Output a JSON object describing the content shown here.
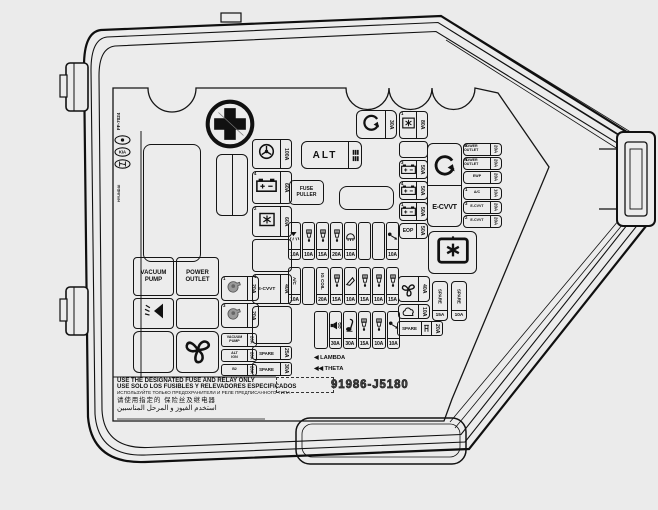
{
  "cover": {
    "part_number": "91986-J5180",
    "side_code": "FF-7024",
    "side_brand": "HYUNDAI"
  },
  "warnings": [
    "USE THE DESIGNATED FUSE AND RELAY ONLY",
    "USE SOLO LOS FUSIBLES Y RELEVADORES ESPECIFICADOS",
    "ИСПОЛЬЗУЙТЕ ТОЛЬКО ПРЕДОХРАНИТЕЛИ И РЕЛЕ ПРЕДПИСАННОГО ТИПА",
    "请使用指定的 保险丝及继电器",
    "استخدم الفيوز و المرحل المناسبين"
  ],
  "legend": {
    "lambda_prefix": "◀",
    "lambda": "LAMBDA",
    "theta_prefix": "◀◀",
    "theta": "THETA"
  },
  "named_boxes": {
    "alt": "ALT",
    "fuse_puller": "FUSE PULLER",
    "ecvvt_big": "E-CVVT",
    "vacuum_pump": "VACUUM PUMP",
    "power_outlet": "POWER OUTLET"
  },
  "col_a": [
    {
      "num": "",
      "icon": "eps-icon",
      "amp": "100A"
    },
    {
      "num": "4",
      "icon": "battery-icon",
      "amp": "60A"
    },
    {
      "num": "2",
      "icon": "star-box-icon",
      "amp": "60A"
    },
    {
      "blank": true
    },
    {
      "num": "1",
      "label": "E-CVVT",
      "amp": "40A"
    },
    {
      "blank": true
    },
    {
      "label": "SPARE",
      "amp": "25A"
    },
    {
      "label": "SPARE",
      "amp": "30A"
    }
  ],
  "top_fuse": {
    "icon": "rotate-arrow-icon",
    "amp": "30A"
  },
  "col_b": [
    {
      "num": "1",
      "icon": "star-box-icon",
      "amp": "80A"
    },
    {
      "num": "3",
      "icon": "battery-icon",
      "amp": "50A"
    },
    {
      "num": "4",
      "icon": "battery-icon",
      "amp": "50A"
    },
    {
      "num": "1",
      "icon": "battery-icon",
      "amp": "50A"
    },
    {
      "label": "EOP",
      "amp": "50A"
    }
  ],
  "right_col": [
    {
      "num": "2",
      "label": "POWER OUTLET",
      "amp": "20A"
    },
    {
      "num": "1",
      "label": "POWER OUTLET",
      "amp": "20A"
    },
    {
      "num": "",
      "label": "EWP",
      "amp": "20A"
    },
    {
      "num": "1",
      "label": "A/C",
      "amp": "10A"
    },
    {
      "num": "3",
      "label": "E-CVVT",
      "amp": "20A"
    },
    {
      "num": "2",
      "label": "E-CVVT",
      "amp": "20A"
    }
  ],
  "row1": [
    {
      "icon": "washer-icon",
      "amp": "10A"
    },
    {
      "icon": "injector-icon",
      "amp": "10A"
    },
    {
      "icon": "injector-icon",
      "amp": "15A"
    },
    {
      "icon": "injector-icon",
      "amp": "20A"
    },
    {
      "icon": "lamp-icon",
      "amp": "10A"
    },
    {
      "blank": true
    },
    {
      "blank": true
    },
    {
      "icon": "sensor-icon",
      "amp": "10A"
    }
  ],
  "row2": [
    {
      "label": "A/C",
      "amp": "10A"
    },
    {
      "blank": true
    },
    {
      "label": "IG COIL",
      "amp": "20A"
    },
    {
      "icon": "injector-icon",
      "amp": "15A"
    },
    {
      "icon": "cone-icon",
      "amp": "10A"
    },
    {
      "icon": "injector-icon",
      "amp": "15A"
    },
    {
      "icon": "injector-icon",
      "amp": "10A"
    },
    {
      "icon": "injector-icon",
      "amp": "15A"
    }
  ],
  "row3": [
    {
      "blank": true
    },
    {
      "icon": "horn-icon",
      "amp": "30A"
    },
    {
      "icon": "trumpet-icon",
      "amp": "30A"
    },
    {
      "icon": "injector-icon",
      "amp": "15A"
    },
    {
      "icon": "injector-icon",
      "amp": "10A"
    },
    {
      "icon": "sensor-icon",
      "amp": "10A"
    }
  ],
  "relay_col": [
    {
      "num": "1",
      "icon": "pump-icon",
      "amp": "20A"
    },
    {
      "num": "3",
      "icon": "pump-icon",
      "amp": "20A"
    }
  ],
  "mini_col": [
    {
      "label": "VACUUM PUMP",
      "amp": "20A"
    },
    {
      "label": "ALT IGN",
      "amp": "20A"
    },
    {
      "label": "B2",
      "amp": "20A"
    }
  ],
  "right_cluster": {
    "fan": {
      "icon": "fan-icon",
      "amp": "40A"
    },
    "vapor": {
      "icon": "canister-icon",
      "amp": "10A"
    },
    "spare_v1": {
      "label": "SPARE",
      "amp": "15A"
    },
    "spare_v2": {
      "label": "SPARE",
      "amp": "10A"
    },
    "spare_h": {
      "label": "SPARE",
      "icon": "puller-icon",
      "amp": "20A"
    }
  }
}
